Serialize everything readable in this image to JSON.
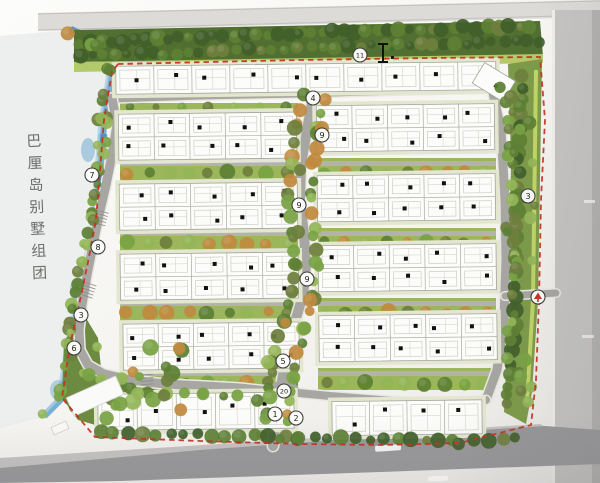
{
  "site_label": {
    "text": "巴厘岛别墅组团",
    "chars": [
      "巴",
      "厘",
      "岛",
      "别",
      "墅",
      "组",
      "团"
    ]
  },
  "markers": [
    {
      "label": "11",
      "x": 360,
      "y": 55
    },
    {
      "label": "4",
      "x": 313,
      "y": 98
    },
    {
      "label": "9",
      "x": 322,
      "y": 135
    },
    {
      "label": "7",
      "x": 92,
      "y": 175
    },
    {
      "label": "9",
      "x": 299,
      "y": 205
    },
    {
      "label": "3",
      "x": 528,
      "y": 196
    },
    {
      "label": "8",
      "x": 98,
      "y": 247
    },
    {
      "label": "9",
      "x": 307,
      "y": 279
    },
    {
      "label": "3",
      "x": 81,
      "y": 315
    },
    {
      "label": "6",
      "x": 74,
      "y": 348
    },
    {
      "label": "5",
      "x": 283,
      "y": 361
    },
    {
      "label": "20",
      "x": 284,
      "y": 391
    },
    {
      "label": "1",
      "x": 275,
      "y": 414
    },
    {
      "label": "2",
      "x": 296,
      "y": 418
    }
  ],
  "entrance_marker": {
    "x": 538,
    "y": 297
  },
  "section_marker": {
    "x": 383,
    "y": 53
  },
  "colors": {
    "boundary_red": "#c6301f",
    "water_blue": "#68a8d1",
    "water_deep": "#3f7fae",
    "water_light": "#aed0e5",
    "road_gray": "#a7a6a2",
    "curb": "#e9e8e2",
    "tree_dark": "#3f5f2a",
    "tree_mid": "#5c8034",
    "tree_light": "#79a344",
    "tree_pale": "#93b657",
    "tree_olive": "#6e7f3d",
    "tree_tan": "#c08a3e",
    "lawn": "#b2ca6a",
    "lime": "#c8dc6a",
    "strip_green": "#9cb65b",
    "belt_green": "#516f31",
    "buffer_green": "#7d9a49",
    "villa_white": "#fcfcfa",
    "marker_ink": "#1c1c1a",
    "lake_fill": "#ecefed"
  }
}
